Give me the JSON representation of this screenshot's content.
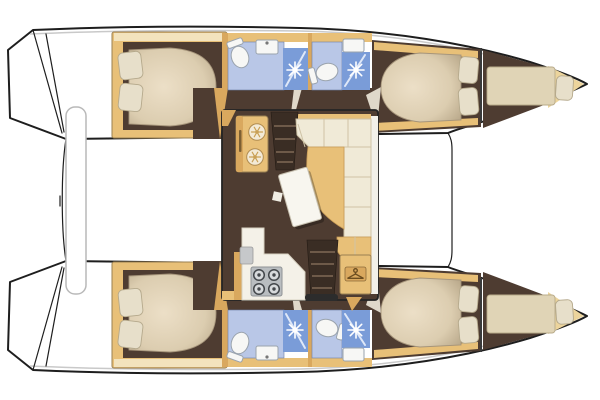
{
  "vessel": {
    "type": "catamaran sailing yacht",
    "view": "top-down interior layout plan",
    "orientation": {
      "bow": "right",
      "stern": "left"
    },
    "cabins": 4,
    "heads": 4,
    "port_hull": [
      "aft double cabin with two pillows",
      "aft head with shower stall",
      "forward head with shower stall",
      "forward double cabin with two pillows",
      "forepeak berth with pillow"
    ],
    "starboard_hull": [
      "aft double cabin with two pillows",
      "aft head with shower stall",
      "forward head with shower stall",
      "forward double cabin with two pillows",
      "forepeak berth with pillow"
    ],
    "bridgedeck_salon": [
      "twin round sinks unit",
      "companionway stairs to port hull",
      "L-shaped settee",
      "tan chaise cushion",
      "saloon table",
      "galley counter",
      "four-burner stove",
      "galley sink",
      "companionway stairs to starboard hull",
      "hanging locker"
    ],
    "cockpit": [
      "aft bench"
    ],
    "foredeck": [
      "forward crossbeam between hulls"
    ]
  },
  "icons": {
    "shower": "white starburst rays",
    "sink_drain": "six-spoke snowflake in round sink",
    "stove_burner": "ringed circle with center dot",
    "hanging_locker": "coat hanger glyph",
    "toilet": "oval bowl with tank"
  },
  "colors": {
    "hull_outline": "#1e1e1e",
    "deck_shadow": "#c9c9c9",
    "floor_brown": "#4e3c31",
    "stairs_brown": "#3a2d24",
    "stair_tread": "#6e5a49",
    "wood_tan": "#e8c078",
    "wood_tan_dark": "#d9a85e",
    "wood_tan_light": "#f3e3bd",
    "bow_tan": "#ecd49c",
    "frame_edge": "#9a8052",
    "tanseat_edge": "#c79a55",
    "upholstery_cream": "#f0ead7",
    "upholstery_seam": "#cfc3a6",
    "bed_light": "#ecdfc7",
    "bed_mid": "#dccdb0",
    "bed_shade": "#b3a284",
    "pillow": "#e7dfca",
    "pillow_edge": "#b5a98c",
    "bath_floor_blue": "#b9c7e7",
    "bath_panel_blue": "#7a9cd8",
    "fixture_white": "#f7f7f5",
    "fixture_edge": "#9aa3ad",
    "counter_white": "#f4f1e8",
    "appliance_gray": "#b9bdc0",
    "table_white": "#f8f6ef",
    "forepeak_cream": "#e0d4b6"
  }
}
